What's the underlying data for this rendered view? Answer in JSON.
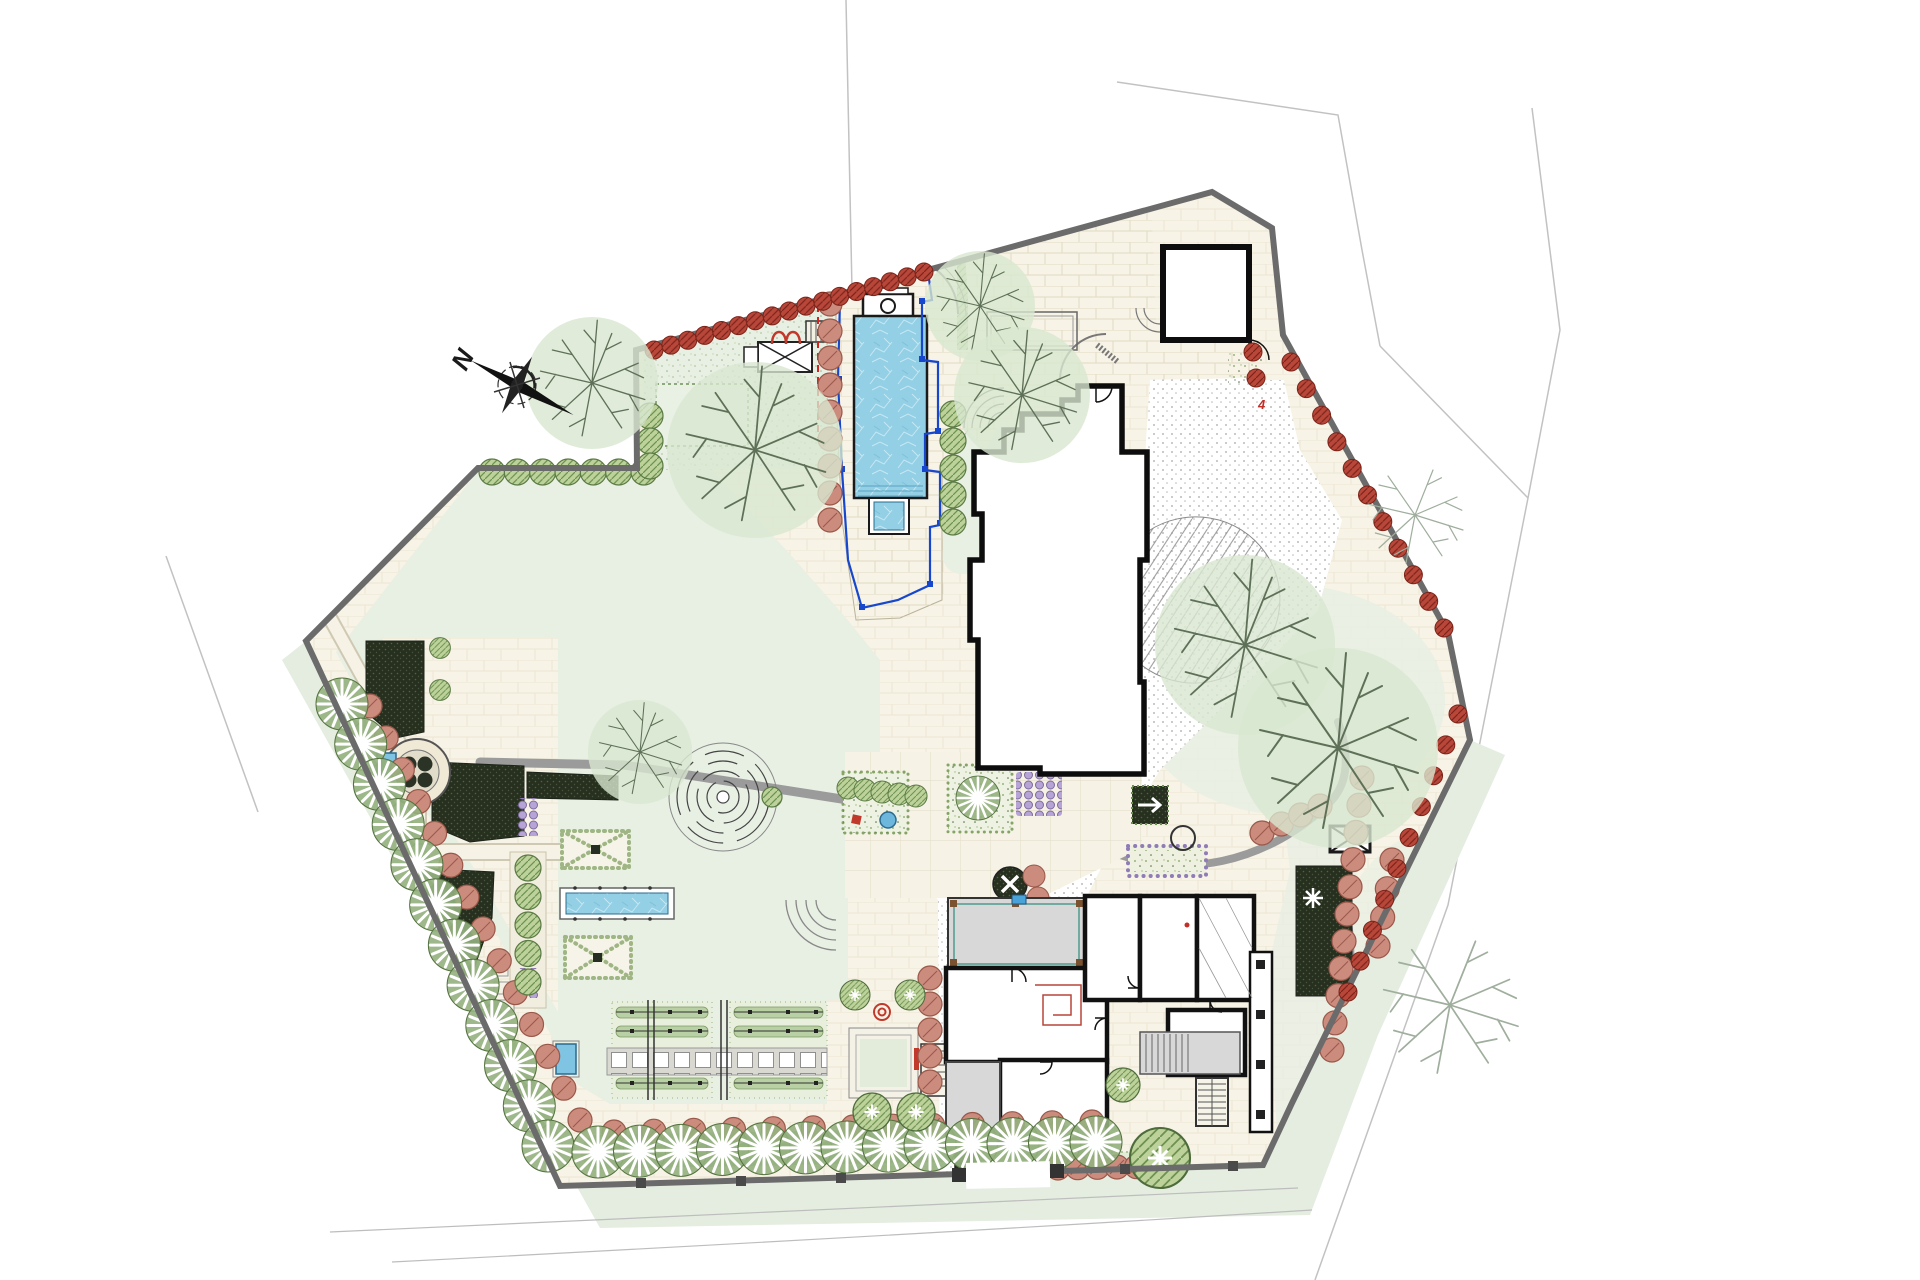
{
  "compass": {
    "label": "N"
  },
  "annotations": {
    "plant_code": "4"
  },
  "colors": {
    "lawn": "#e8efe3",
    "paving": "#f7f3e6",
    "water": "#8fcfe5",
    "boundary": "#6b6b6b",
    "wall": "#111111",
    "fence": "#1747cc",
    "terrace": "#d8d8d8",
    "hedge": "#bcd29a",
    "darkplant": "#27301f",
    "redhedge": "#b8473a",
    "pinktree": "#cb8b7d",
    "canopy": "#d8e7d0",
    "branch": "#5e7158",
    "stipple": "#8f8f8f",
    "path": "#9b9b9b",
    "purple": "#b7a4d6",
    "verge": "#e4ede0"
  },
  "planting_rows": [
    {
      "group": "g-palms",
      "symbol": "sym-palm",
      "start": [
        342,
        704
      ],
      "end": [
        548,
        1146
      ],
      "count": 12
    },
    {
      "group": "g-palms",
      "symbol": "sym-palm",
      "start": [
        598,
        1152
      ],
      "end": [
        1096,
        1142
      ],
      "count": 13
    },
    {
      "group": "g-pink",
      "symbol": "sym-pinktree",
      "start": [
        370,
        706
      ],
      "end": [
        580,
        1120
      ],
      "count": 14
    },
    {
      "group": "g-pink",
      "symbol": "sym-pinktree",
      "start": [
        614,
        1132
      ],
      "end": [
        1092,
        1122
      ],
      "count": 13
    },
    {
      "group": "g-pink",
      "symbol": "sym-pinktree",
      "start": [
        830,
        304
      ],
      "end": [
        830,
        520
      ],
      "count": 9
    },
    {
      "group": "g-pink",
      "symbol": "sym-pinktree",
      "start": [
        1362,
        778
      ],
      "end": [
        1332,
        1050
      ],
      "count": 11
    },
    {
      "group": "g-pink",
      "symbol": "sym-pinktree",
      "start": [
        1262,
        833
      ],
      "end": [
        1320,
        806
      ],
      "count": 4
    },
    {
      "group": "g-pink",
      "symbol": "sym-pinktree",
      "start": [
        1392,
        860
      ],
      "end": [
        1378,
        946
      ],
      "count": 4
    },
    {
      "group": "g-pink",
      "symbol": "sym-pinktree",
      "start": [
        1058,
        1168
      ],
      "end": [
        1176,
        1166
      ],
      "count": 7
    },
    {
      "group": "g-pink",
      "symbol": "sym-pinktree",
      "start": [
        930,
        978
      ],
      "end": [
        930,
        1082
      ],
      "count": 5
    },
    {
      "group": "g-redhedge",
      "symbol": "sym-redhedge",
      "start": [
        654,
        350
      ],
      "end": [
        924,
        272
      ],
      "count": 17
    },
    {
      "group": "g-redhedge",
      "symbol": "sym-redhedge",
      "start": [
        1291,
        362
      ],
      "end": [
        1444,
        628
      ],
      "count": 11
    },
    {
      "group": "g-redhedge",
      "symbol": "sym-redhedge",
      "start": [
        1458,
        714
      ],
      "end": [
        1348,
        992
      ],
      "count": 10
    },
    {
      "group": "g-redhedge",
      "symbol": "sym-redhedge",
      "start": [
        1253,
        352
      ],
      "end": [
        1256,
        378
      ],
      "count": 2
    },
    {
      "group": "g-bubbles",
      "symbol": "sym-bubble",
      "start": [
        492,
        472
      ],
      "end": [
        644,
        472
      ],
      "count": 7
    },
    {
      "group": "g-bubbles",
      "symbol": "sym-bubble",
      "start": [
        650,
        416
      ],
      "end": [
        650,
        466
      ],
      "count": 3
    },
    {
      "group": "g-bubbles",
      "symbol": "sym-bubble",
      "start": [
        953,
        414
      ],
      "end": [
        953,
        522
      ],
      "count": 5
    },
    {
      "group": "g-bubbles",
      "symbol": "sym-bubble",
      "start": [
        528,
        868
      ],
      "end": [
        528,
        982
      ],
      "count": 5
    },
    {
      "group": "g-bubbles",
      "symbol": "sym-bubble",
      "start": [
        848,
        788
      ],
      "end": [
        916,
        796
      ],
      "count": 5,
      "scale": 0.85
    },
    {
      "group": "g-bubbles",
      "symbol": "sym-bubble",
      "start": [
        440,
        648
      ],
      "end": [
        440,
        690
      ],
      "count": 2,
      "scale": 0.8
    }
  ],
  "trees": [
    {
      "kind": "canopy",
      "x": 592,
      "y": 383,
      "r": 66
    },
    {
      "kind": "canopy",
      "x": 755,
      "y": 450,
      "r": 88
    },
    {
      "kind": "canopy",
      "x": 980,
      "y": 306,
      "r": 55
    },
    {
      "kind": "canopy",
      "x": 1022,
      "y": 395,
      "r": 68
    },
    {
      "kind": "canopy",
      "x": 640,
      "y": 752,
      "r": 52
    },
    {
      "kind": "canopy",
      "x": 1245,
      "y": 645,
      "r": 90
    },
    {
      "kind": "canopy",
      "x": 1338,
      "y": 748,
      "r": 100
    },
    {
      "kind": "lines",
      "x": 1450,
      "y": 1005,
      "r": 85
    },
    {
      "kind": "lines",
      "x": 1415,
      "y": 515,
      "r": 60
    },
    {
      "kind": "round",
      "x": 855,
      "y": 995,
      "r": 15
    },
    {
      "kind": "round",
      "x": 910,
      "y": 995,
      "r": 15
    },
    {
      "kind": "round",
      "x": 872,
      "y": 1112,
      "r": 19
    },
    {
      "kind": "round",
      "x": 916,
      "y": 1112,
      "r": 19
    },
    {
      "kind": "round",
      "x": 1123,
      "y": 1085,
      "r": 17
    },
    {
      "kind": "round",
      "x": 1160,
      "y": 1158,
      "r": 30
    },
    {
      "kind": "palm",
      "x": 978,
      "y": 798,
      "r": 22
    }
  ]
}
